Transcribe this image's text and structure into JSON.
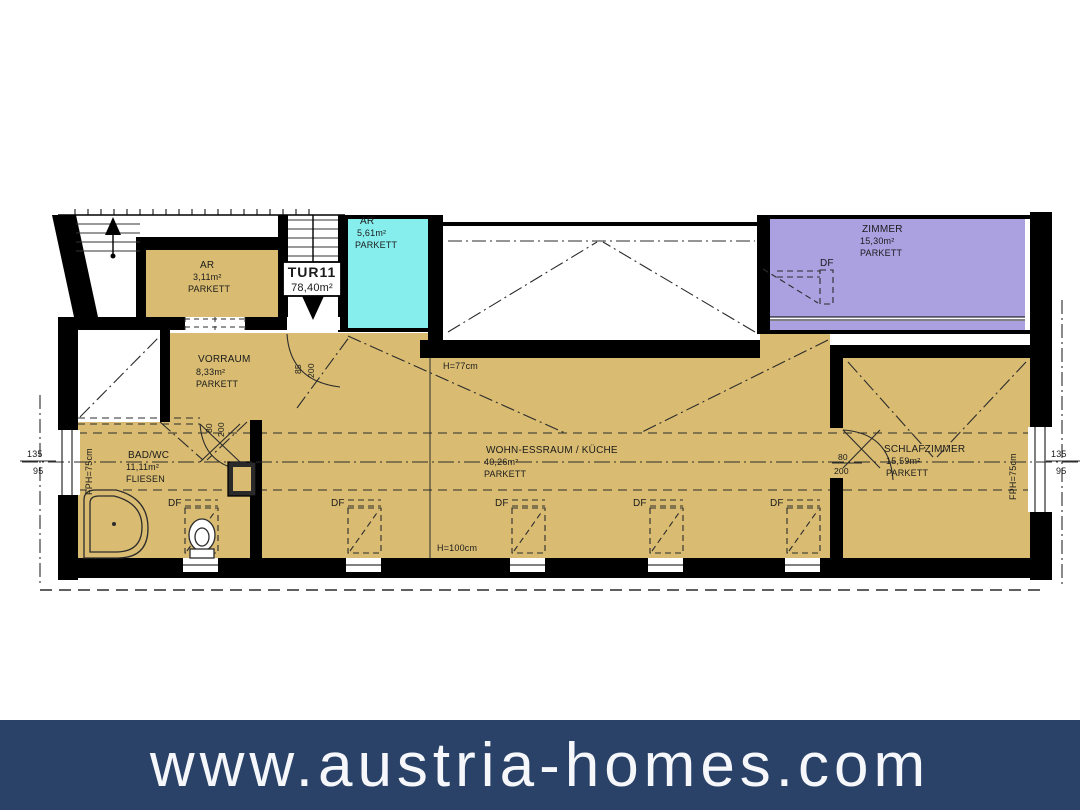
{
  "plan": {
    "unit_box": {
      "label": "TUR11",
      "area": "78,40m²"
    },
    "rooms": {
      "ar_top": {
        "name": "AR",
        "area": "3,11m²",
        "floor": "PARKETT"
      },
      "ar_cyan": {
        "name": "AR",
        "area": "5,61m²",
        "floor": "PARKETT"
      },
      "zimmer": {
        "name": "ZIMMER",
        "area": "15,30m²",
        "floor": "PARKETT"
      },
      "vorraum": {
        "name": "VORRAUM",
        "area": "8,33m²",
        "floor": "PARKETT"
      },
      "bad_wc": {
        "name": "BAD/WC",
        "area": "11,11m²",
        "floor": "FLIESEN"
      },
      "wohn_essraum": {
        "name": "WOHN-ESSRAUM / KÜCHE",
        "area": "40,26m²",
        "floor": "PARKETT"
      },
      "schlafzimmer": {
        "name": "SCHLAFZIMMER",
        "area": "15,59m²",
        "floor": "PARKETT"
      }
    },
    "labels": {
      "df": "DF",
      "h77": "H=77cm",
      "h100": "H=100cm",
      "fph": "FPH=75cm",
      "win_135": "135",
      "win_95": "95",
      "door85_w": "85",
      "door80_w": "80",
      "door_h": "200"
    },
    "colors": {
      "parquet": "#d9bc72",
      "storage": "#86efee",
      "bedroom": "#aba0e0",
      "wall": "#000000"
    }
  },
  "banner": {
    "text": "www.austria-homes.com",
    "bg": "#2a4168",
    "fg": "#f5f7fa"
  }
}
